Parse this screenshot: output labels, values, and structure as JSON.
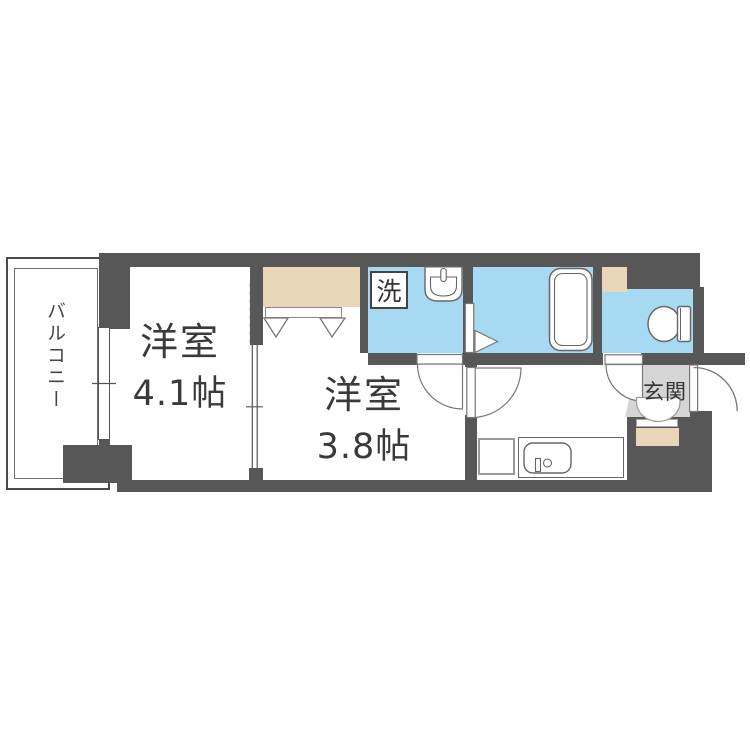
{
  "floor_plan": {
    "balcony": {
      "label": "バルコニー"
    },
    "room_41": {
      "name": "洋室",
      "area": "4.1帖"
    },
    "room_38": {
      "name": "洋室",
      "area": "3.8帖"
    },
    "washer": {
      "label": "洗"
    },
    "entrance": {
      "label": "玄関"
    },
    "colors": {
      "wall": "#575757",
      "wet_area": "#a8d9f2",
      "storage": "#e9d6b8",
      "entrance_floor": "#d5d5d5",
      "line": "#777777",
      "text": "#3a3a3a"
    },
    "fixture_icons": [
      "wash-basin-icon",
      "bathtub-icon",
      "toilet-icon",
      "kitchen-sink-icon",
      "closet-hanger-icon",
      "shoe-cabinet",
      "window",
      "sliding-door",
      "door-swing",
      "entrance-door-swing"
    ]
  }
}
